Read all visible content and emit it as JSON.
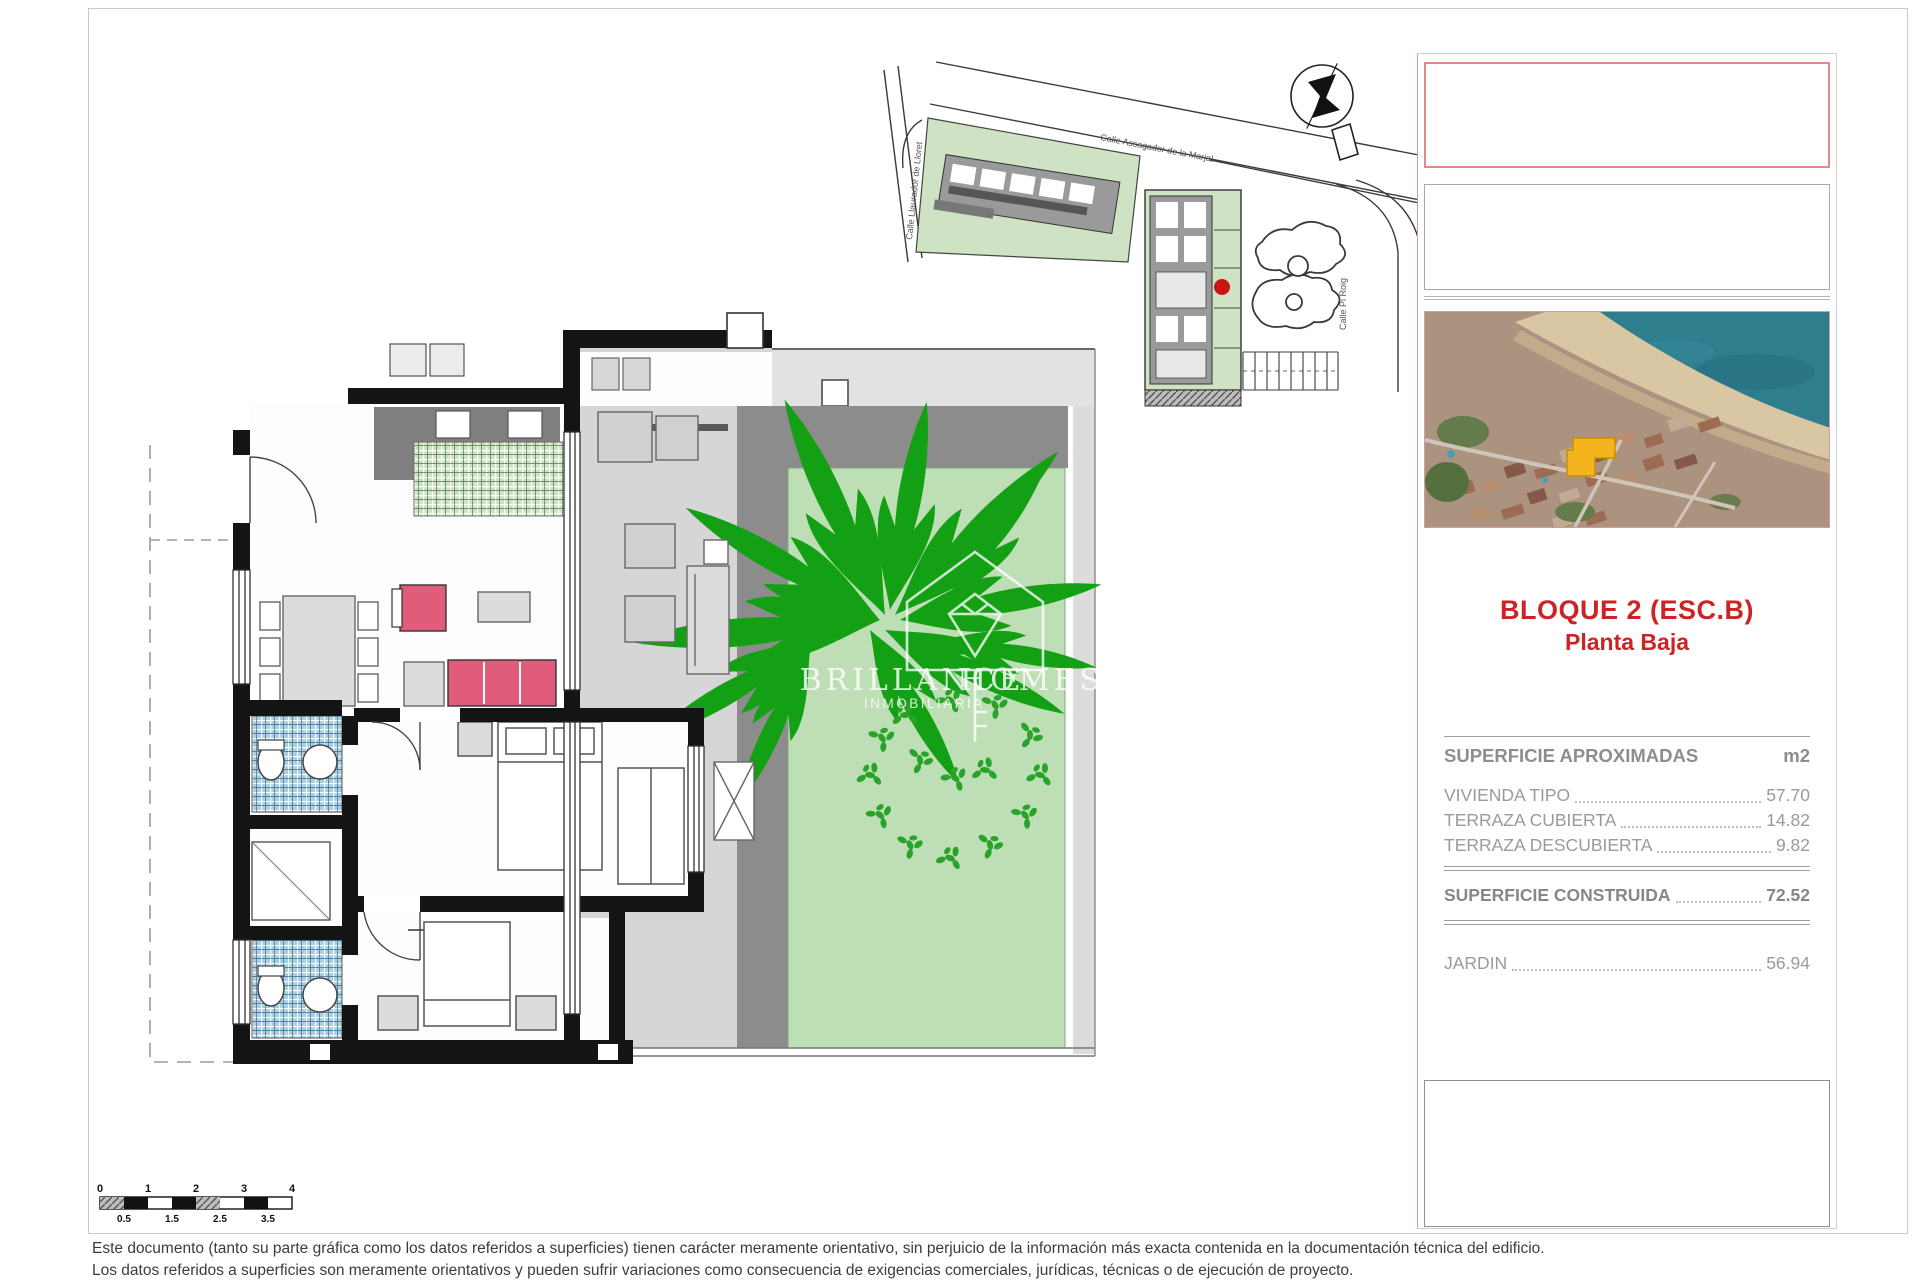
{
  "panel": {
    "title_line1": "BLOQUE 2 (ESC.B)",
    "title_line2": "Planta Baja",
    "table": {
      "header": "SUPERFICIE APROXIMADAS",
      "unit": "m2",
      "rows": [
        {
          "label": "VIVIENDA TIPO",
          "value": "57.70"
        },
        {
          "label": "TERRAZA CUBIERTA",
          "value": "14.82"
        },
        {
          "label": "TERRAZA DESCUBIERTA",
          "value": "9.82"
        }
      ],
      "total": {
        "label": "SUPERFICIE CONSTRUIDA",
        "value": "72.52"
      },
      "extra": {
        "label": "JARDIN",
        "value": "56.94"
      }
    }
  },
  "watermark": {
    "brand_left": "BRILLANCE",
    "brand_right": "HOMES",
    "subtitle": "INMOBILIARIA"
  },
  "site_plan": {
    "street_top": "Calle Assagador de la Marjal",
    "street_left": "Calle Llaurador de Lloret",
    "street_right": "Calle Pi Roig"
  },
  "scale_bar": {
    "top_labels": [
      "0",
      "1",
      "2",
      "3",
      "4"
    ],
    "bottom_labels": [
      "0.5",
      "1.5",
      "2.5",
      "3.5"
    ]
  },
  "disclaimer": {
    "line1": "Este documento (tanto su parte gráfica como los datos referidos a superficies) tienen carácter meramente orientativo, sin perjuicio de la información más exacta contenida en la documentación técnica del edificio.",
    "line2": "Los datos referidos a superficies son meramente orientativos y pueden sufrir variaciones como consecuencia de exigencias comerciales, jurídicas, técnicas o de ejecución de proyecto."
  },
  "colors": {
    "accent_red": "#cc2424",
    "box_border_red": "#e08a8a",
    "garden_green": "#bedfb6",
    "palm_green": "#14a014",
    "shrub_green": "#2aa32a",
    "kitchen_tile": "#cfe3c4",
    "bath_tile": "#a9cfe2",
    "terrace_gray": "#d6d6d6",
    "band_gray": "#8c8c8c",
    "wall_black": "#141414",
    "sofa_pink": "#e05c7a",
    "site_red_dot": "#cc1414",
    "aerial_marker_yellow": "#f4b41d",
    "aerial_sea": "#2e7e8e",
    "aerial_sand": "#d9c7a4",
    "aerial_town": "#ac937f"
  }
}
